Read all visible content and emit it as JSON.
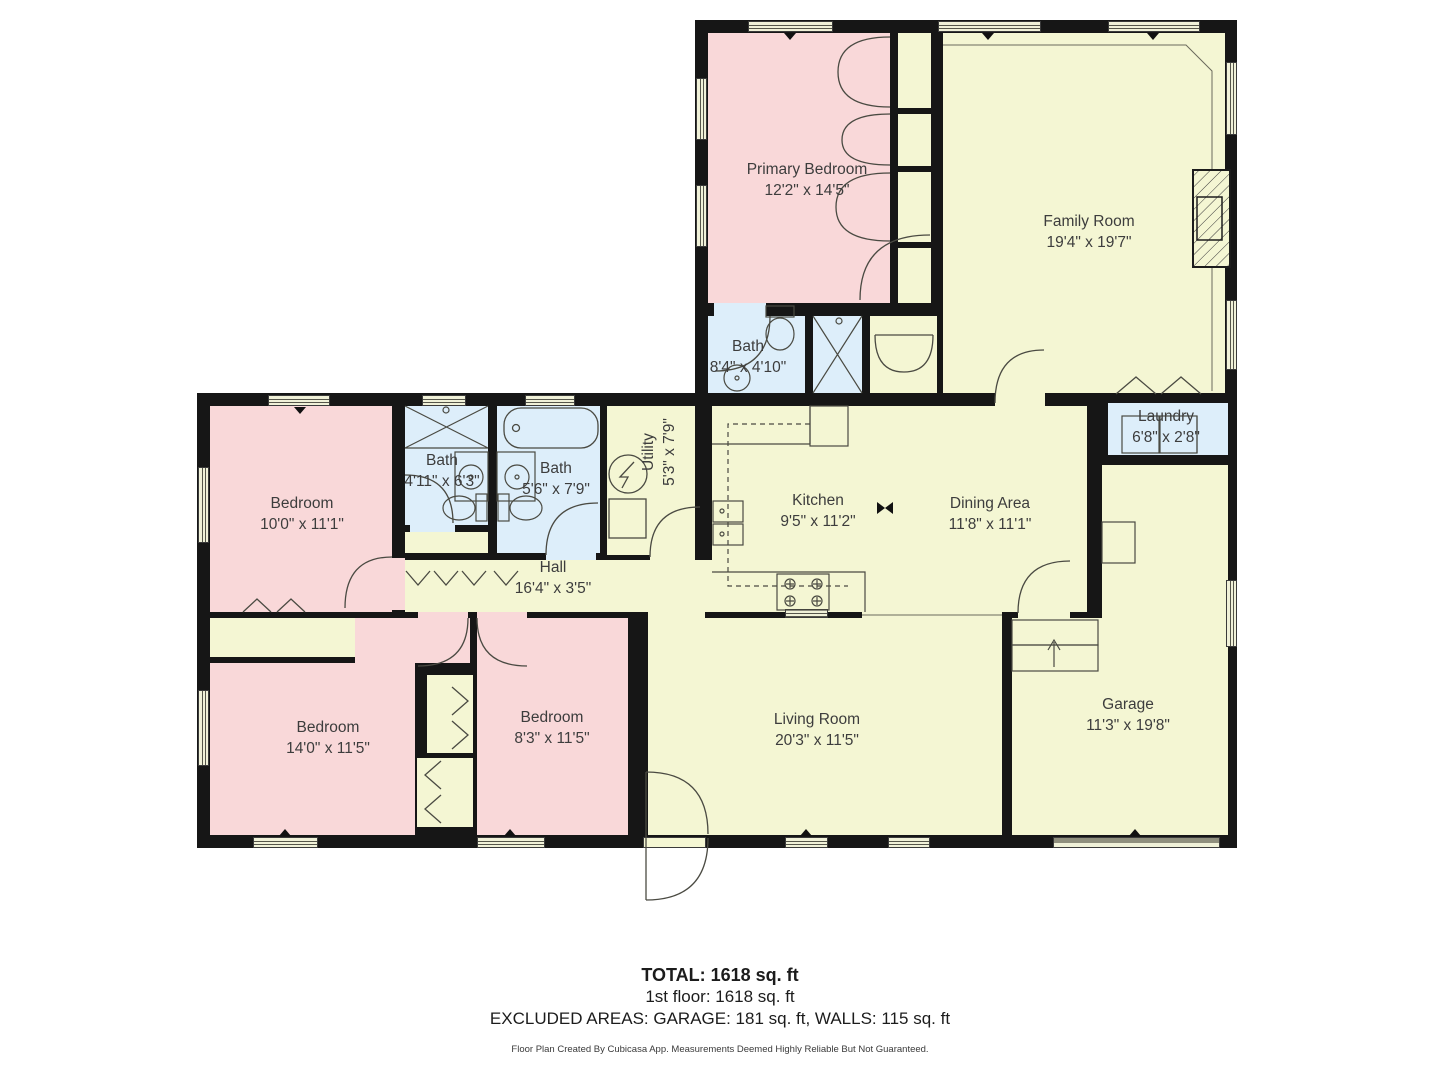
{
  "rooms": {
    "primary_bedroom": {
      "name": "Primary Bedroom",
      "dims": "12'2\" x 14'5\""
    },
    "family_room": {
      "name": "Family Room",
      "dims": "19'4\" x 19'7\""
    },
    "bath_primary": {
      "name": "Bath",
      "dims": "8'4\" x 4'10\""
    },
    "laundry": {
      "name": "Laundry",
      "dims": "6'8\" x 2'8\""
    },
    "bedroom_nw": {
      "name": "Bedroom",
      "dims": "10'0\" x 11'1\""
    },
    "bath_hall": {
      "name": "Bath",
      "dims": "4'11\" x 6'3\""
    },
    "bath_main": {
      "name": "Bath",
      "dims": "5'6\" x 7'9\""
    },
    "utility": {
      "name": "Utility",
      "dims": "5'3\" x 7'9\""
    },
    "kitchen": {
      "name": "Kitchen",
      "dims": "9'5\" x 11'2\""
    },
    "dining_area": {
      "name": "Dining Area",
      "dims": "11'8\" x 11'1\""
    },
    "hall": {
      "name": "Hall",
      "dims": "16'4\" x 3'5\""
    },
    "bedroom_sw": {
      "name": "Bedroom",
      "dims": "14'0\" x 11'5\""
    },
    "bedroom_s": {
      "name": "Bedroom",
      "dims": "8'3\" x 11'5\""
    },
    "living_room": {
      "name": "Living Room",
      "dims": "20'3\" x 11'5\""
    },
    "garage": {
      "name": "Garage",
      "dims": "11'3\" x 19'8\""
    }
  },
  "summary": {
    "total": "TOTAL: 1618 sq. ft",
    "first_floor": "1st floor: 1618 sq. ft",
    "excluded": "EXCLUDED AREAS: GARAGE: 181 sq. ft, WALLS: 115 sq. ft",
    "disclaimer": "Floor Plan Created By Cubicasa App. Measurements Deemed Highly Reliable But Not Guaranteed."
  },
  "colors": {
    "room_pink": "#f9d8d9",
    "room_yellow": "#f4f6d3",
    "room_blue": "#ddeefa",
    "wall": "#161616",
    "window_fill": "#f0f1d8",
    "garage_door_gray": "#8f8f7d",
    "label_text": "#3d3d3d"
  }
}
